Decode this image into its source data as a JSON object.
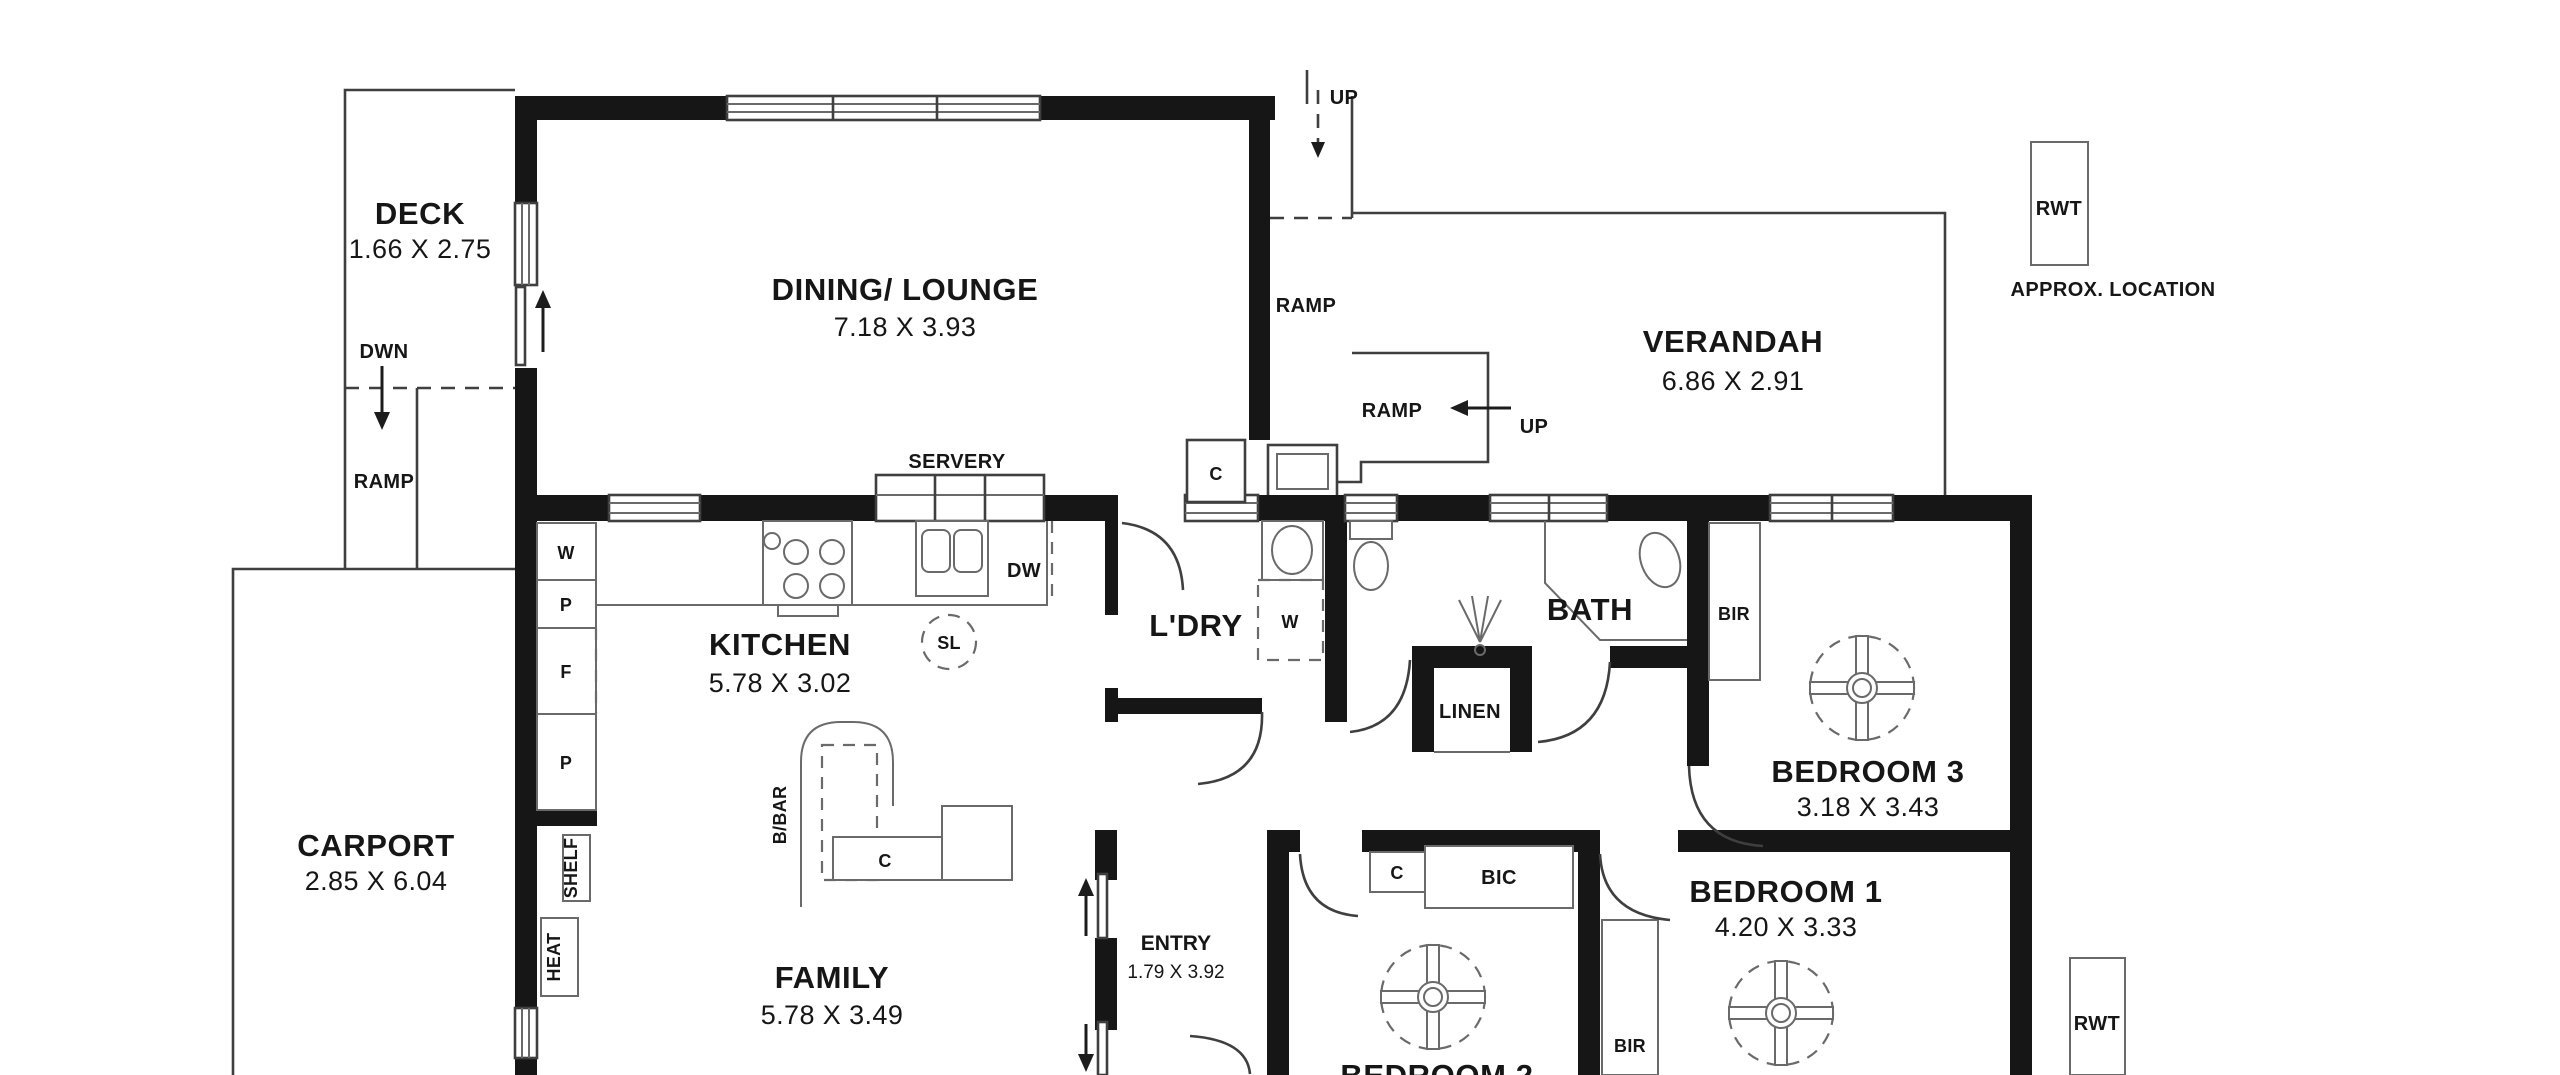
{
  "plan": {
    "type": "residential floor plan",
    "rooms": [
      {
        "name": "DECK",
        "dims": "1.66 X 2.75"
      },
      {
        "name": "DINING/ LOUNGE",
        "dims": "7.18 X 3.93"
      },
      {
        "name": "VERANDAH",
        "dims": "6.86 X 2.91"
      },
      {
        "name": "KITCHEN",
        "dims": "5.78 X 3.02"
      },
      {
        "name": "L'DRY",
        "dims": ""
      },
      {
        "name": "BATH",
        "dims": ""
      },
      {
        "name": "BEDROOM 3",
        "dims": "3.18 X 3.43"
      },
      {
        "name": "CARPORT",
        "dims": "2.85 X 6.04"
      },
      {
        "name": "FAMILY",
        "dims": "5.78 X 3.49"
      },
      {
        "name": "ENTRY",
        "dims": "1.79 X 3.92"
      },
      {
        "name": "BEDROOM 1",
        "dims": "4.20 X 3.33"
      },
      {
        "name": "BEDROOM 2",
        "dims": ""
      }
    ],
    "fixtures": {
      "dwn": "DWN",
      "ramp_deck": "RAMP",
      "ramp_upper": "RAMP",
      "ramp_mid": "RAMP",
      "up_top": "UP",
      "up_mid": "UP",
      "servery": "SERVERY",
      "dw": "DW",
      "sl": "SL",
      "bbar": "B/BAR",
      "cupboard_w": "W",
      "cupboard_p1": "P",
      "cupboard_f": "F",
      "cupboard_p2": "P",
      "shelf": "SHELF",
      "heat": "HEAT",
      "washer": "W",
      "linen": "LINEN",
      "c_dining": "C",
      "c_kitchen": "C",
      "c_bed2": "C",
      "bic": "BIC",
      "bir_bed3": "BIR",
      "bir_bed1": "BIR",
      "rwt_top": "RWT",
      "rwt_bottom": "RWT",
      "approx_location": "APPROX. LOCATION"
    },
    "colors": {
      "background": "#ffffff",
      "walls": "#161616",
      "thin_lines": "#3f3f3f"
    }
  }
}
